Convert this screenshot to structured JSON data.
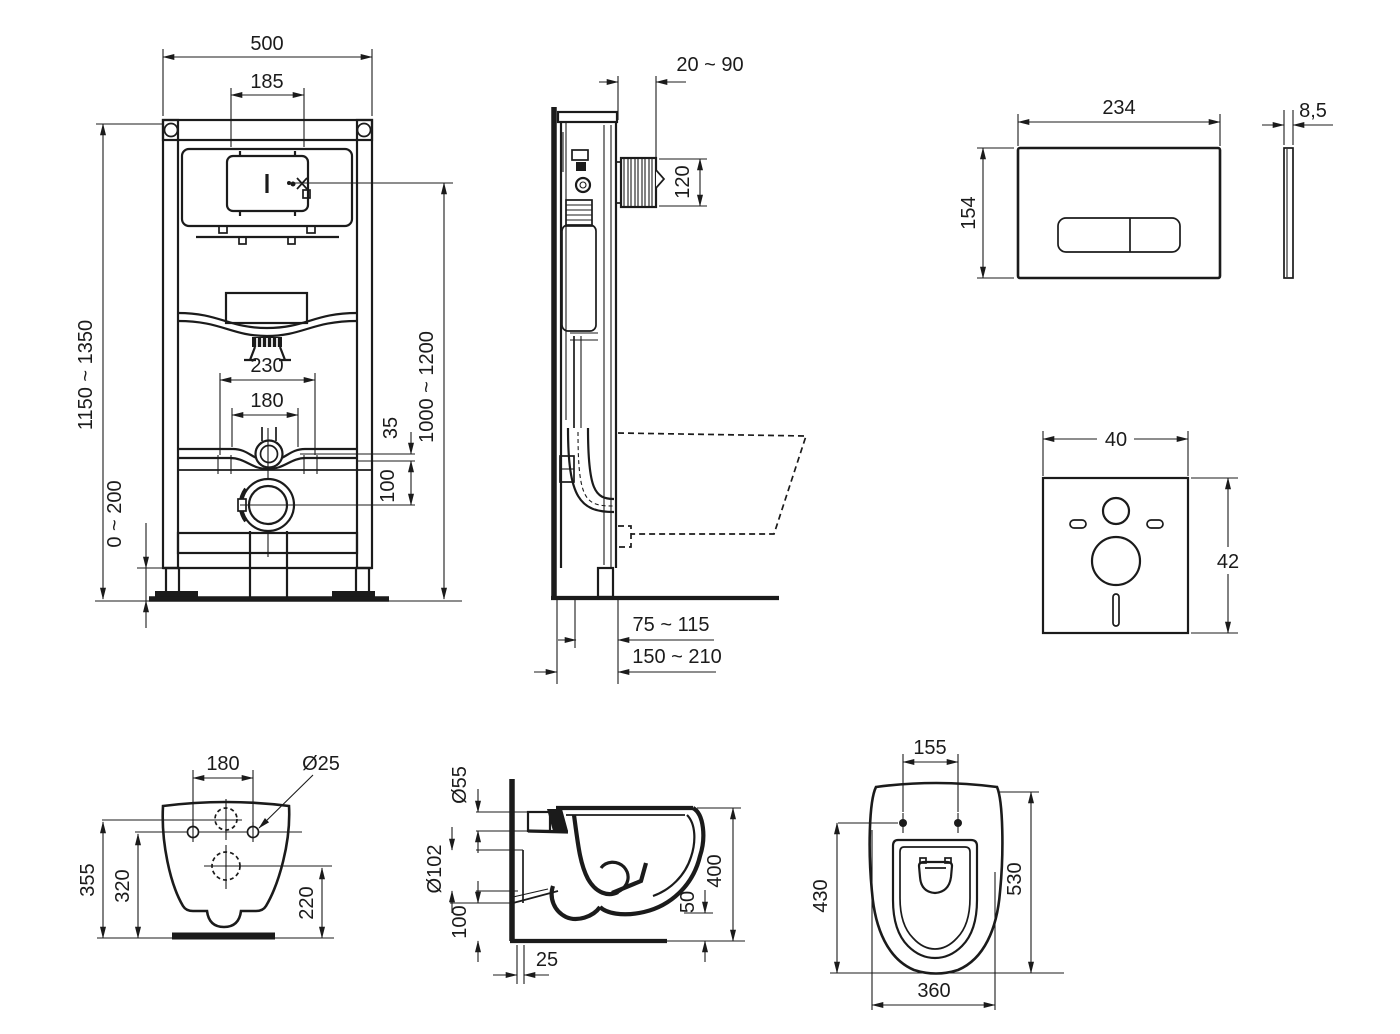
{
  "accent_color": "#1b1b1b",
  "background_color": "#ffffff",
  "dims": {
    "frame_front": {
      "width": "500",
      "flush_opening": "185",
      "height": "1150 ~ 1350",
      "panel_height": "1000 ~ 1200",
      "fix_outer": "230",
      "fix_inner": "180",
      "supply_gap": "35",
      "outlet_gap": "100",
      "foot_adjust": "0 ~ 200"
    },
    "frame_side": {
      "wall_offset": "20 ~ 90",
      "bend_height": "120",
      "outlet_axis": "75 ~ 115",
      "depth": "150 ~ 210"
    },
    "flush_plate": {
      "width": "234",
      "height": "154",
      "thickness": "8,5"
    },
    "sound_mat": {
      "width": "40",
      "height": "42"
    },
    "pan_rear": {
      "fix_spread": "180",
      "fix_hole": "Ø25",
      "h_total": "355",
      "h_fix": "320",
      "h_outlet": "220"
    },
    "pan_side": {
      "d_seat": "Ø55",
      "d_outlet": "Ø102",
      "h_outlet": "100",
      "wall_gap": "25",
      "clearance": "50",
      "height": "400"
    },
    "pan_top": {
      "fix_spread": "155",
      "l_fix": "430",
      "l_total": "530",
      "width": "360"
    }
  }
}
